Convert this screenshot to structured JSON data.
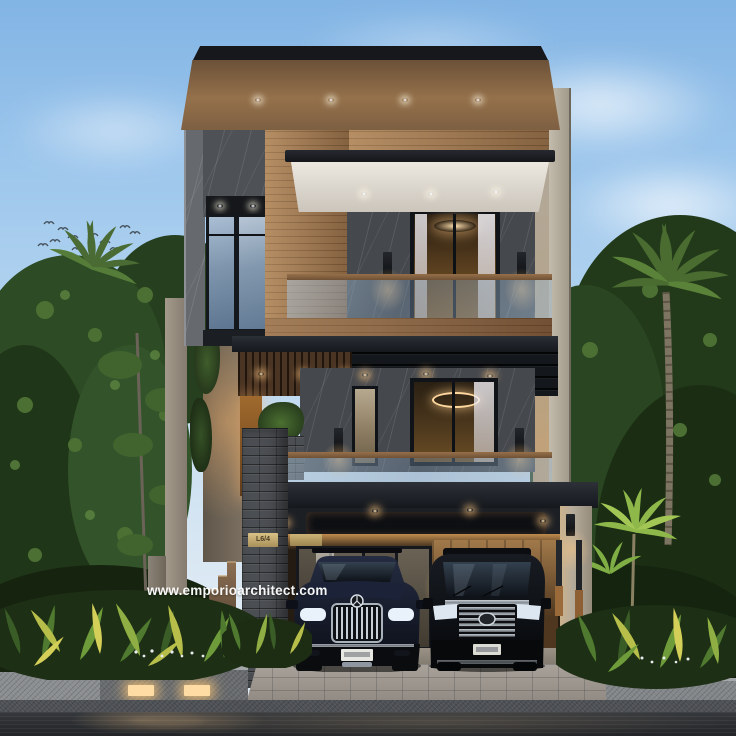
{
  "scene": {
    "description": "3D architectural rendering of a modern tropical 3-storey house at dusk, street view, with glass balconies, wood and marble facade, a two-car carport (dark SUV and black van), palm trees, tropical planters, wet asphalt road and a flock of birds in the sky",
    "watermark": "www.emporioarchitect.com",
    "house_sign": "L6/4"
  },
  "palette": {
    "sky_top": "#82b4e4",
    "sky_horizon": "#dde9f3",
    "roof_fascia": "#1a1d21",
    "wood_facade": "#a1774e",
    "marble_dark": "#4b4f54",
    "concrete_light": "#b6ae9f",
    "canopy_dark": "#23262b",
    "glass_blue": "#8ca3bc",
    "interior_warm_light": "#ffd9a0",
    "foliage_dark": "#223a1e",
    "foliage_light": "#8fb84b",
    "suv_body": "#171c2b",
    "van_body": "#0a0c10",
    "road_wet": "#2b2e31",
    "paver": "#9e9890",
    "watermark_color": "#ffffff"
  }
}
